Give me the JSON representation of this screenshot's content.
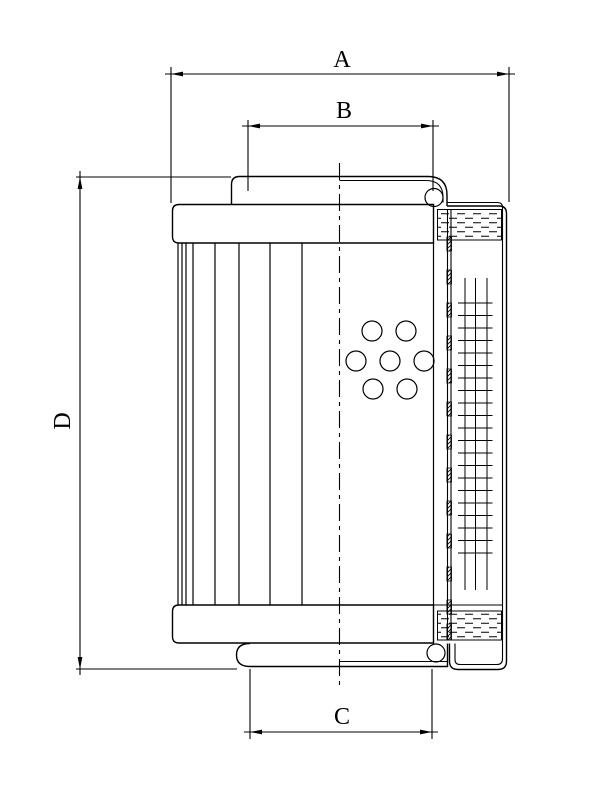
{
  "drawing": {
    "type": "technical-drawing",
    "subject": "filter element sectioned side view",
    "background_color": "#ffffff",
    "line_color": "#000000",
    "dimension_labels": {
      "a": "A",
      "b": "B",
      "c": "C",
      "d": "D"
    }
  }
}
